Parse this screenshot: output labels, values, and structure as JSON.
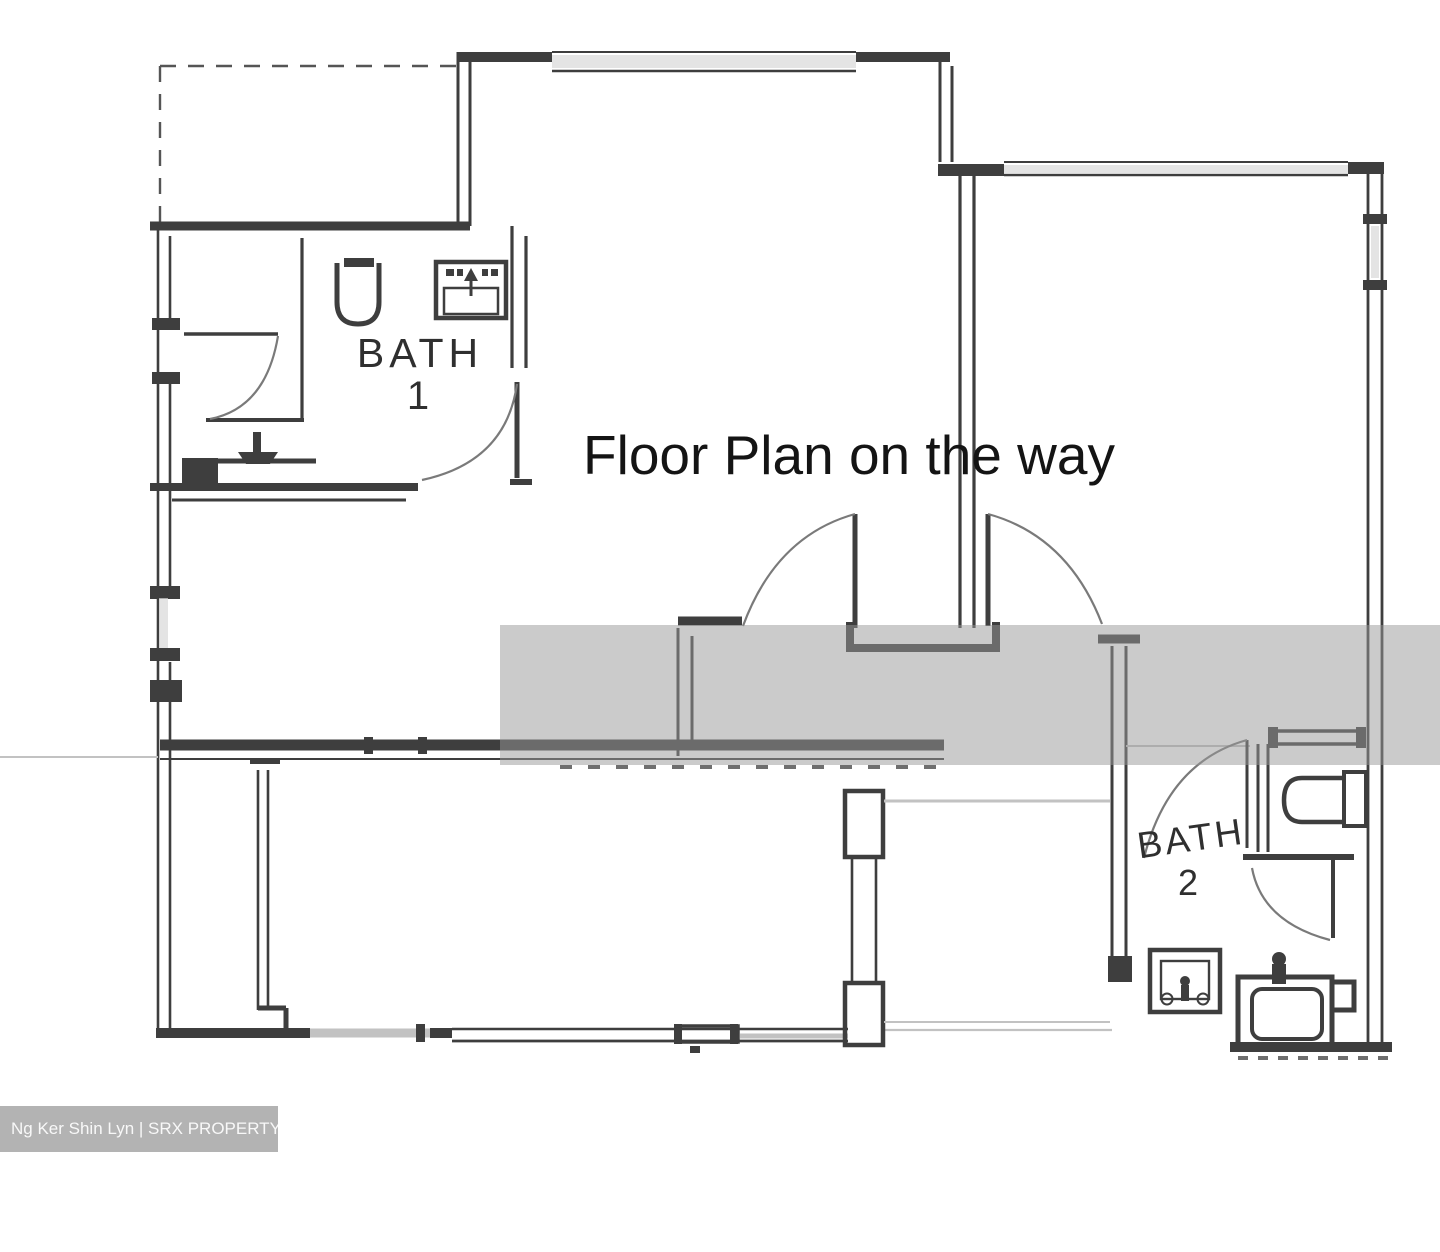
{
  "overlay": {
    "message": "Floor Plan on the way"
  },
  "rooms": {
    "bath1": {
      "name": "BATH",
      "number": "1"
    },
    "bath2": {
      "name": "BATH",
      "number": "2"
    }
  },
  "watermark": {
    "text": "Ng Ker Shin Lyn | SRX PROPERTY",
    "agent": "Ng Ker Shin Lyn",
    "brand": "SRX PROPERTY"
  },
  "colors": {
    "background": "#ffffff",
    "wall": "#3e3e3e",
    "door_arc": "#7a7a7a",
    "light_line": "#c2c2c2",
    "glaze": "#d9d9d9",
    "overlay_band": "#989898",
    "watermark_bg": "#b3b3b3",
    "watermark_text": "#f8f8f8",
    "label_text": "#2f2f2f",
    "message_text": "#141414"
  }
}
